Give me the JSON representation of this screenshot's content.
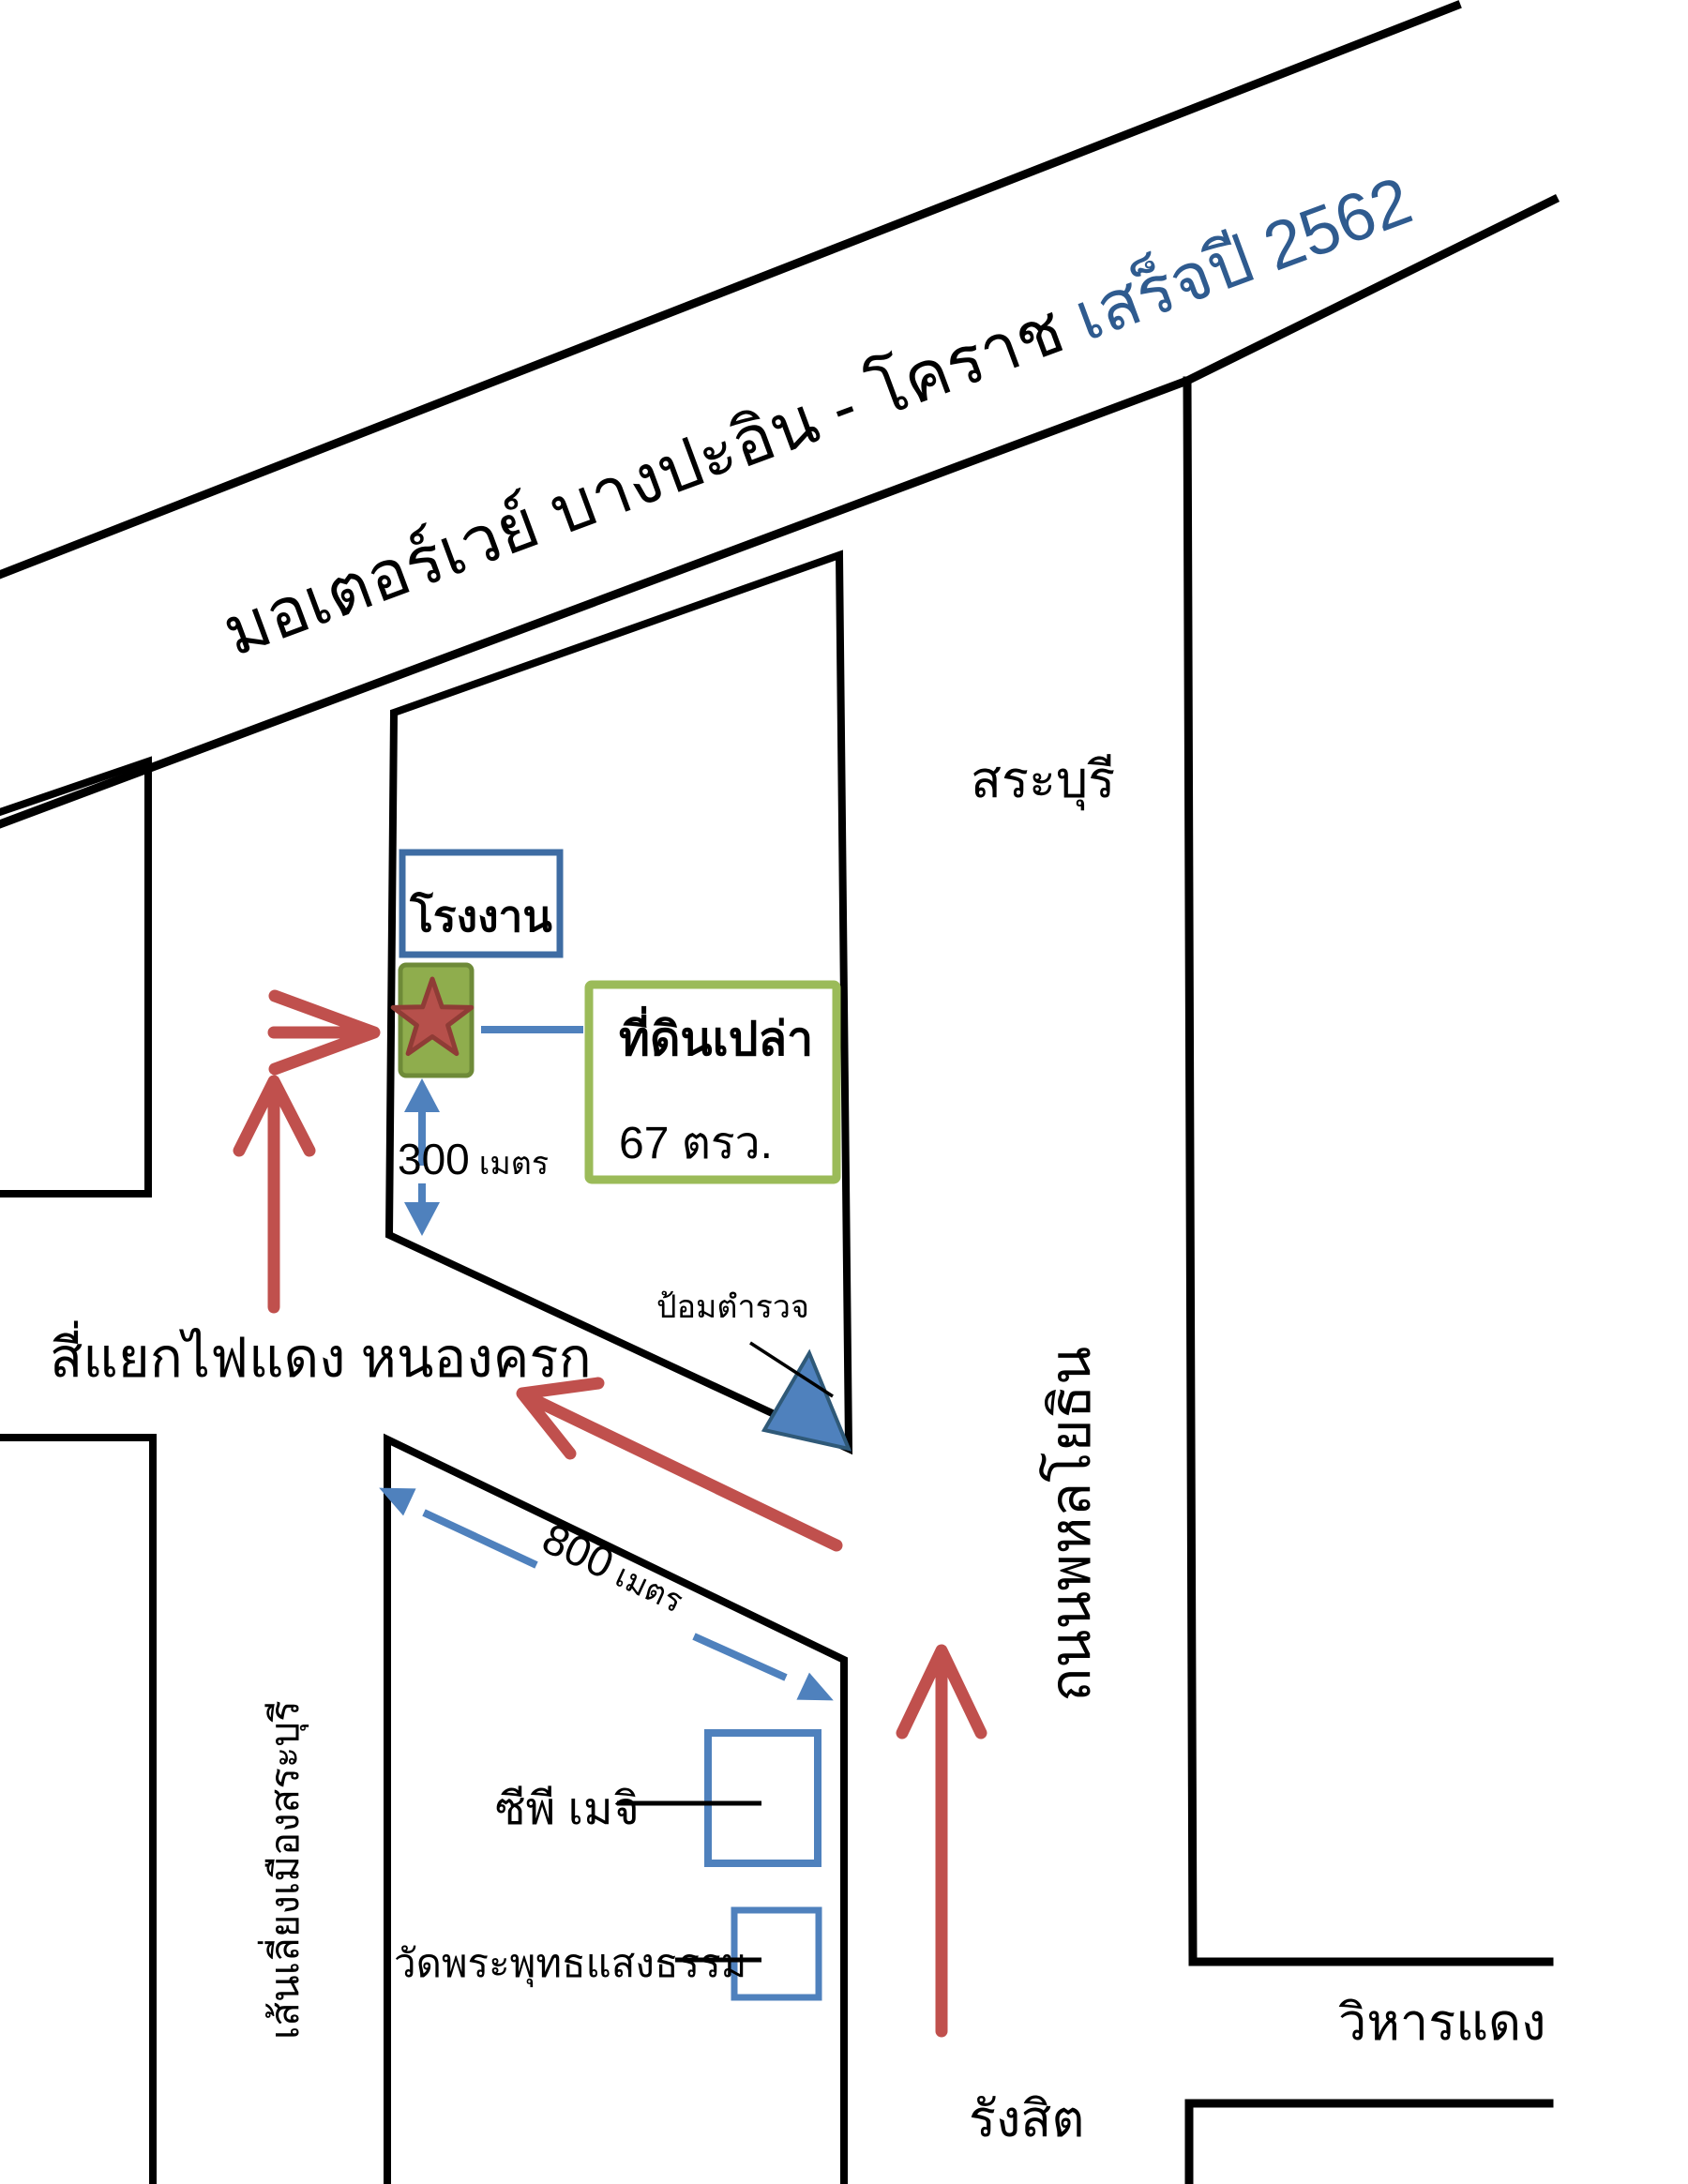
{
  "motorway": {
    "name": "มอเตอร์เวย์ บางปะอิน - โคราช",
    "completion": "เสร็จปี 2562"
  },
  "roads": {
    "phahonyothin": "ถนนพหลโยธิน",
    "saraburi_bypass": "เส้นเลี่ยงเมืองสระบุรี"
  },
  "directions": {
    "north": "สระบุรี",
    "south": "รังสิต",
    "east": "วิหารแดง"
  },
  "intersection": {
    "label": "สี่แยกไฟแดง หนองครก"
  },
  "landmarks": {
    "factory": "โรงงาน",
    "police_box": "ป้อมตำรวจ",
    "cp_meiji": "ซีพี เมจิ",
    "temple": "วัดพระพุทธแสงธรรม"
  },
  "land_plot": {
    "name": "ที่ดินเปล่า",
    "area": "67 ตรว."
  },
  "distances": {
    "to_main_road": {
      "value": "300",
      "unit": "เมตร"
    },
    "along_street": {
      "value": "800",
      "unit": "เมตร"
    }
  },
  "colors": {
    "route_red": "#c0504d",
    "measure_blue": "#4f81bd",
    "star_red_fill": "#b6504b",
    "star_red_border": "#8f3c36",
    "land_marker_green_fill": "#8fad4d",
    "land_marker_green_border": "#6e8a38",
    "plot_box_green_border": "#9bbb59",
    "factory_box_blue": "#3e6ca3",
    "completion_year_blue": "#2f5b8f",
    "road_black": "#000000"
  }
}
